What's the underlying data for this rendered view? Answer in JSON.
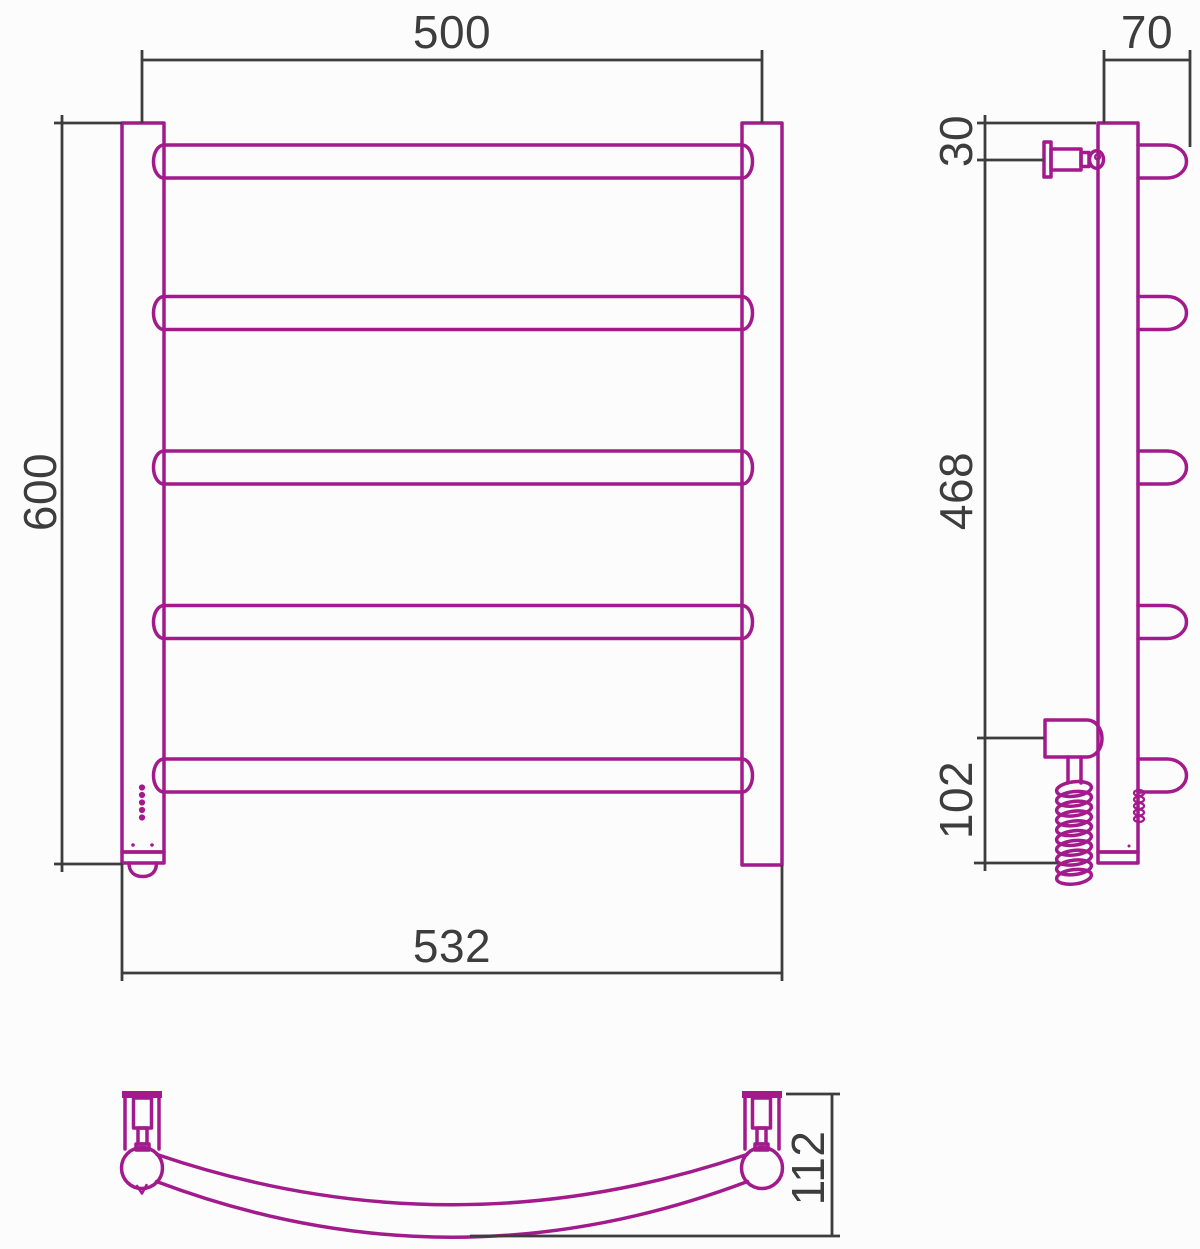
{
  "labels": {
    "front_width": "500",
    "front_height": "600",
    "front_overall_width": "532",
    "side_depth": "70",
    "side_top_offset": "30",
    "side_span": "468",
    "side_bottom_offset": "102",
    "top_depth": "112"
  },
  "colors": {
    "outline": "#a21a8c",
    "dimension": "#3d3d3d",
    "background": "#fcfcfc"
  }
}
